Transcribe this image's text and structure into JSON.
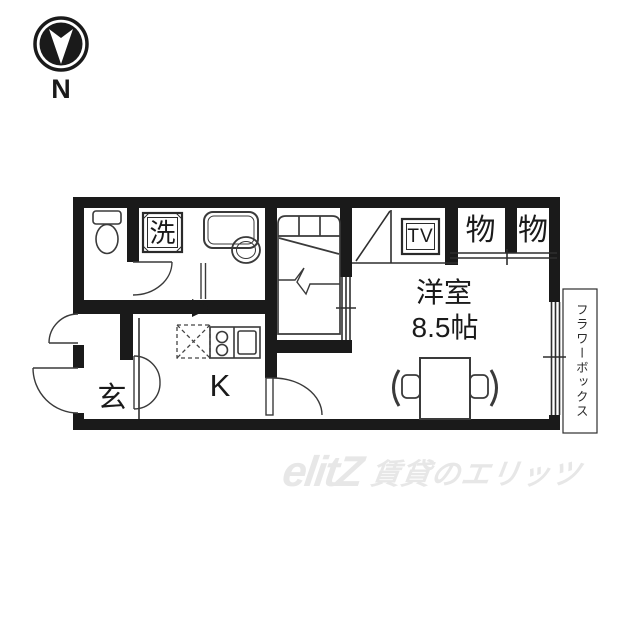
{
  "canvas": {
    "width": 640,
    "height": 640,
    "background": "#ffffff"
  },
  "compass": {
    "label": "N"
  },
  "floor_plan": {
    "colors": {
      "wall": "#1a1a1a",
      "line": "#2e2e2e",
      "floor": "#ffffff"
    },
    "labels": {
      "laundry": "洗",
      "tv": "TV",
      "storage_left": "物",
      "storage_right": "物",
      "room_name": "洋室",
      "room_size": "8.5帖",
      "entrance": "玄",
      "kitchen": "K",
      "flower_box": "フラワーボックス"
    }
  },
  "watermark": {
    "logo": "elitZ",
    "text": "賃貸のエリッツ",
    "color": "#e7e7e7"
  }
}
